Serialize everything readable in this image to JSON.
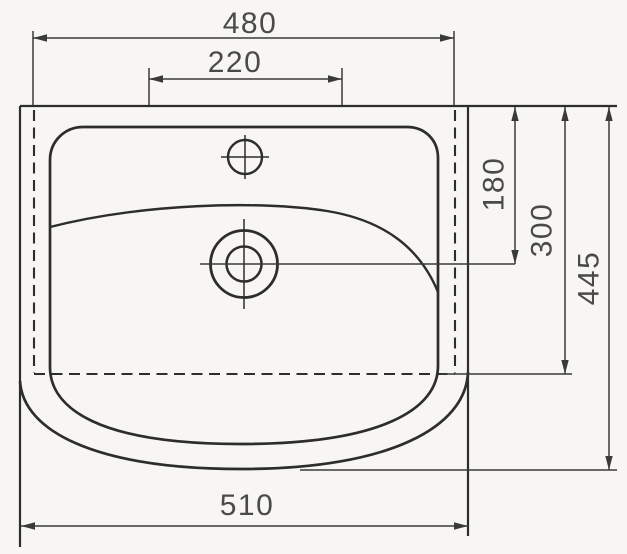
{
  "drawing": {
    "subject": "washbasin-plan-view-technical-drawing",
    "units_shown": "millimeters (implied, unlabeled)",
    "dimensions": {
      "top_overall_width": {
        "value": "480",
        "orientation": "horizontal",
        "position": "top"
      },
      "faucet_platform_width": {
        "value": "220",
        "orientation": "horizontal",
        "position": "top"
      },
      "rim_to_drain_center": {
        "value": "180",
        "orientation": "vertical",
        "position": "right"
      },
      "rim_to_hidden_edge": {
        "value": "300",
        "orientation": "vertical",
        "position": "right"
      },
      "overall_depth": {
        "value": "445",
        "orientation": "vertical",
        "position": "right"
      },
      "bottom_overall_width": {
        "value": "510",
        "orientation": "horizontal",
        "position": "bottom"
      }
    },
    "colors": {
      "outline": "#2d2d2d",
      "dim_line": "#3a3a3a",
      "text": "#4a4a4a",
      "background": "#f7f6f3"
    }
  }
}
